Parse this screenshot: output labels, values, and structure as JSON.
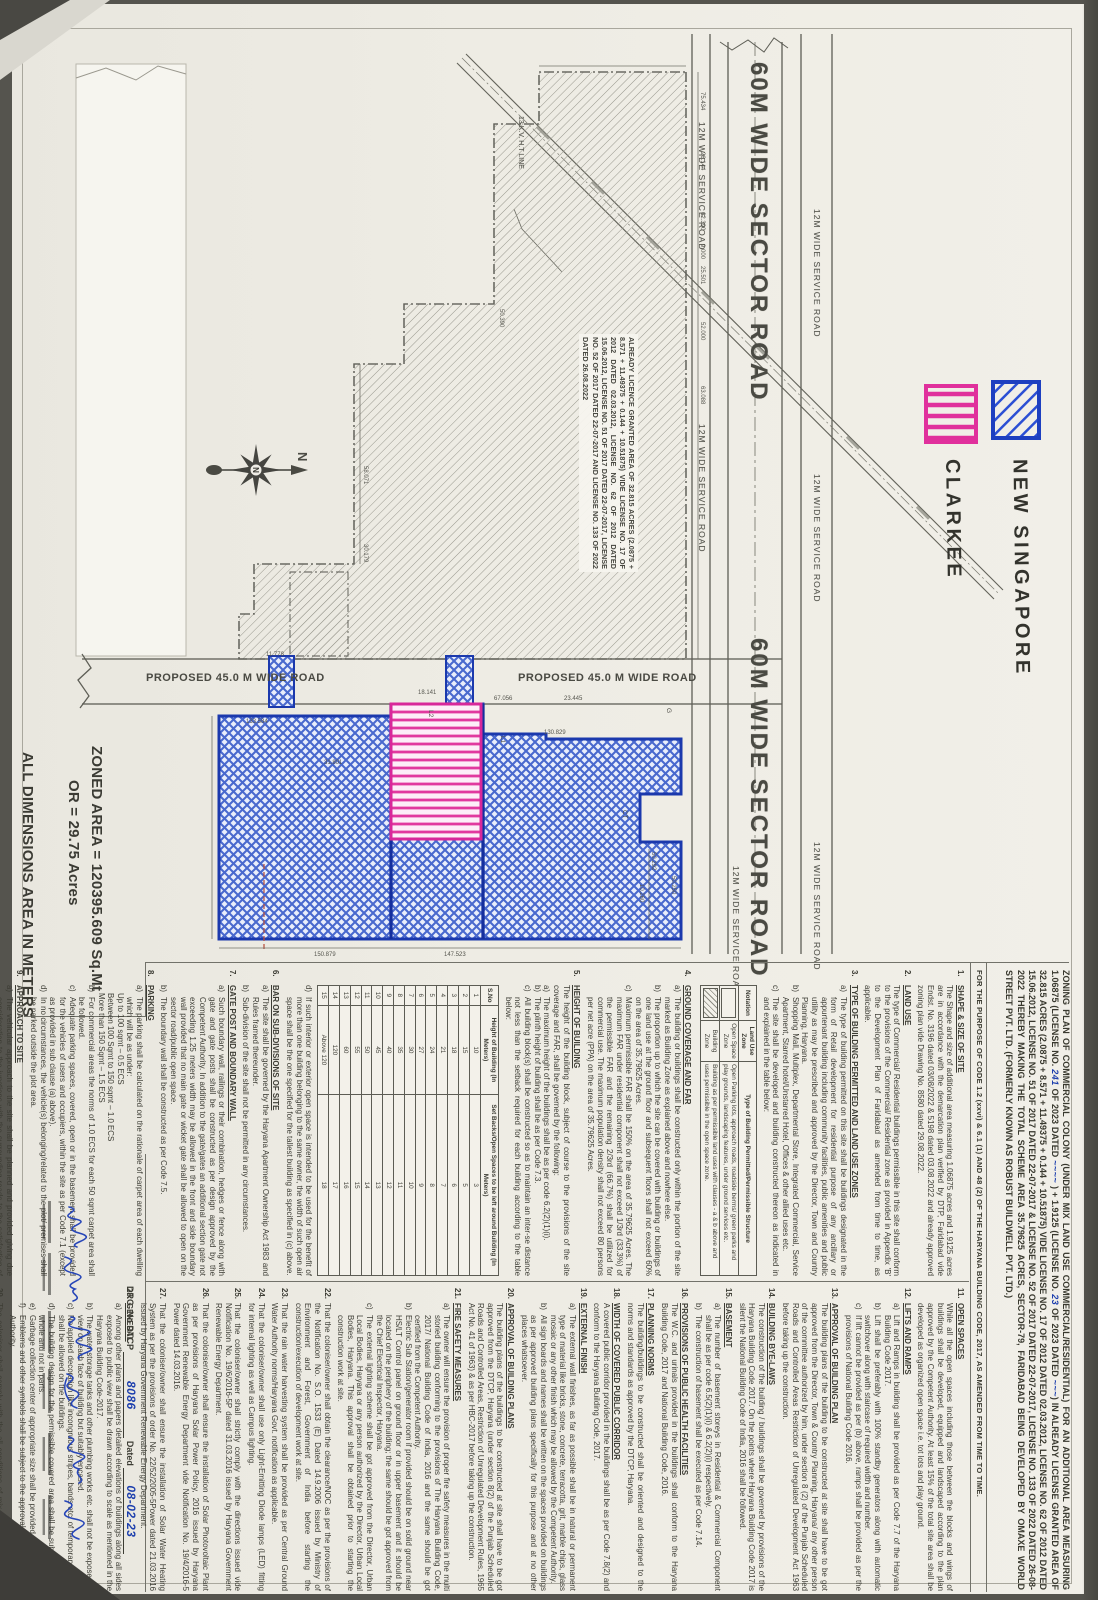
{
  "legend": {
    "items": [
      {
        "label": "NEW SINGAPORE",
        "color": "#2b4fd4",
        "swatch": "blue-diagonal-hatch"
      },
      {
        "label": "CLARKEE",
        "color": "#e0309c",
        "swatch": "pink-stripe-hatch"
      }
    ]
  },
  "compass": {
    "label": "N"
  },
  "roads": {
    "sector": "60M WIDE SECTOR ROAD",
    "service": "12M WIDE SERVICE ROAD",
    "proposed": "PROPOSED 45.0 M WIDE ROAD",
    "ht_line": "13 K.V. H.T LINE"
  },
  "area_note": {
    "line1": "ZONED AREA = 120395.609 Sq.Mt",
    "line2": "OR       = 29.75 Acres",
    "line3": "ALL DIMENSIONS AREA IN METERS"
  },
  "licensed_area_text": "ALREADY LICENCE GRANTED AREA OF 32.815 ACRES (2.0875 + 8.571 + 11.49375 + 0.144 + 10.51875) VIDE LICENSE NO. 17 OF 2012 DATED 02.03.2012, LICENSE NO. 62 OF 2012 DATED 15.06.2012, LICENSE NO. 51 OF 2017 DATED 22-07-2017, LICENSE NO. 52 OF 2017 DATED 22-07-2017 AND LICENSE NO. 133 OF 2022 DATED 26.08.2022",
  "plan": {
    "dims": [
      "75.434",
      "26.144",
      "62.390",
      "25.501",
      "52.000",
      "63.088",
      "50.390",
      "11.778",
      "58.071",
      "30.179",
      "67.056",
      "23.445",
      "130.829",
      "31.801",
      "133.584",
      "150.879",
      "147.523",
      "50.292",
      "10.260",
      "50.250",
      "9.000",
      "18.141"
    ],
    "micro_labels": [
      "L1",
      "L2",
      "G",
      "CT"
    ]
  },
  "header": {
    "parts": [
      {
        "t": "ZONING PLAN OF COMMERCIAL COLONY (UNDER MIX LAND USE COMMERCIAL/RESIDENTIAL) FOR AN ADDITIONAL AREA MEASURING 1.06875 (LICENSE NO. "
      },
      {
        "t": "241",
        "hand": true
      },
      {
        "t": " OF 2023 DATED "
      },
      {
        "t": "~~~~",
        "hand": true
      },
      {
        "t": " ) + 1.9125 (LICENSE NO. "
      },
      {
        "t": "23",
        "hand": true
      },
      {
        "t": " OF 2023 DATED "
      },
      {
        "t": "~~~",
        "hand": true
      },
      {
        "t": ") IN ALREADY LICENSE GRANTED AREA OF 32.815 ACRES (2.0875 + 8.571 + 11.49375 + 0.144 + 10.51875) VIDE LICENSE NO. 17 OF 2012 DATED 02.03.2012, LICENSE NO. 62 OF 2012 DATED 15.06.2012, LICENSE NO. 51 OF 2017 DATED 22-07-2017 & LICENSE NO. 52 OF 2017 DATED 22-07-2017, LICENSE NO. 133 OF 2022 DATED 26-08-2022 THEREBY MAKING THE TOTAL SCHEME AREA 35.79625 ACRES, SECTOR-79, FARIDABAD BEING DEVELOPED BY OMAXE WORLD STREET PVT. LTD. (FORMERLY KNOWN AS ROBUST BUILDWELL PVT. LTD.)"
      }
    ],
    "purpose": "FOR THE PURPOSE OF CODE 1.2 (xxvi) & 6.1 (1) AND 48 (2) OF THE HARYANA BUILDING CODE, 2017, AS AMENDED FROM TIME TO TIME."
  },
  "tables": {
    "landuse": {
      "headers": [
        "Notation",
        "Land Use Zone",
        "Type of Building Permitted/Permissible Structure"
      ],
      "rows": [
        {
          "swatch": "open",
          "zone": "Open Space Zone",
          "desc": "Open Parking lots, approach roads, roadside berms/ green parks and play grounds, landscaping features, under ground services etc."
        },
        {
          "swatch": "hatch",
          "zone": "Building Zone",
          "desc": "Building as per permissible land uses with clauses - a & b above and uses permissible in the open space zone."
        }
      ]
    },
    "setback": {
      "headers": [
        "S.No",
        "Height of Building (In Meters)",
        "Set Backs/Open Spaces to be left around Building (In Meters)"
      ],
      "rows": [
        [
          "1",
          "10",
          "3"
        ],
        [
          "2",
          "15",
          "5"
        ],
        [
          "3",
          "18",
          "6"
        ],
        [
          "4",
          "21",
          "7"
        ],
        [
          "5",
          "24",
          "8"
        ],
        [
          "6",
          "27",
          "9"
        ],
        [
          "7",
          "30",
          "10"
        ],
        [
          "8",
          "35",
          "11"
        ],
        [
          "9",
          "40",
          "12"
        ],
        [
          "10",
          "45",
          "13"
        ],
        [
          "11",
          "50",
          "14"
        ],
        [
          "12",
          "55",
          "15"
        ],
        [
          "13",
          "60",
          "16"
        ],
        [
          "14",
          "120",
          "17"
        ],
        [
          "15",
          "Above 120",
          "18"
        ]
      ]
    }
  },
  "notes": {
    "left": [
      {
        "n": "1",
        "h": "SHAPE & SIZE OF SITE",
        "ps": [
          "The Shape and size of additional area measuring 1.06875 acres and 1.9125 acres are in accordance with the demarcation plan verified by DTP, Faridabad vide Endst. No. 3196 dated 03/08/2022 & 5198 dated 03.08.2022 and already approved zoning plan vide Drawing No. 8580 dated 29.08.2022."
        ]
      },
      {
        "n": "2",
        "h": "LAND USE",
        "ps": [
          "The type of Commercial/ Residential buildings permissible in this site shall conform to the provisions of the Commercial/ Residential zone as provided in Appendix 'B' to the Development Plan of Faridabad as amended from time to time, as applicable."
        ]
      },
      {
        "n": "3",
        "h": "TYPE OF BUILDING PERMITTED AND LAND USE ZONES",
        "items": [
          {
            "k": "a",
            "t": "The type of building permitted on this site shall be buildings designated in the form of Retail development for residential purpose of any ancillary or appurtenant building including community facilities, public amenities and public utility as may be prescribed and approved by the Director, Town and Country Planning, Haryana."
          },
          {
            "k": "b",
            "t": "Shopping Mall, Multiplex, Departmental Store, Integrated Commercial, Service Apartment, Starred hotel/Unstarred Hotel, Offices & other allied uses etc."
          },
          {
            "k": "c",
            "t": "The site shall be developed and building constructed thereon as indicated in and explained in the table below:"
          }
        ],
        "table": "landuse"
      },
      {
        "n": "4",
        "h": "GROUND COVERAGE AND FAR",
        "items": [
          {
            "k": "a",
            "t": "The building or buildings shall be constructed only within the portion of the site marked as Building Zone as explained above and nowhere else."
          },
          {
            "k": "b",
            "t": "The proportion up to which the site can be covered with building or buildings of one land use at the ground floor and subsequent floors shall not exceed 60% on the area of 35.79625 Acres."
          },
          {
            "k": "c",
            "t": "Maximum permissible FAR shall be 150% on the area of 35.79625 Acres. The maximum FAR under residential component shall not exceed 1/3rd (33.3%) of the permissible FAR and the remaining 2/3rd (66.7%) shall be utilized for commercial use. The maximum population density shall not exceed 80 persons per net acre (PPA) on the area of 35.79625 Acres."
          }
        ]
      },
      {
        "n": "5",
        "h": "HEIGHT OF BUILDING",
        "ps": [
          "The height of the building block, subject of course to the provisions of the site coverage and FAR, shall be governed by the following:"
        ],
        "items": [
          {
            "k": "a",
            "t": "The maximum height of the buildings shall be as per code 6.2(2)(1)(i)."
          },
          {
            "k": "b",
            "t": "The plinth height of building shall be as per Code 7.3."
          },
          {
            "k": "c",
            "t": "All building block(s) shall be constructed so as to maintain an inter-se distance not less than the setback required for each building according to the table below:"
          }
        ],
        "table": "setback",
        "after": [
          {
            "k": "d",
            "t": "If such interior or exterior open space is intended to be used for the benefit of more than one building belonging to the same owner, the width of such open air space shall be the one specified for the tallest building as specified in (c) above."
          }
        ]
      },
      {
        "n": "6",
        "h": "BAR ON SUB-DIVISIONS OF SITE",
        "items": [
          {
            "k": "a",
            "t": "The site shall be governed by the Haryana Apartment Ownership Act 1983 and Rules framed thereunder."
          },
          {
            "k": "b",
            "t": "Sub-division of the site shall not be permitted in any circumstances."
          }
        ]
      },
      {
        "n": "7",
        "h": "GATE POST AND BOUNDARY WALL",
        "items": [
          {
            "k": "a",
            "t": "Such boundary wall, railings or their combination, hedges or fence along with gate and gate posts shall be constructed as per design approved by the Competent Authority. In addition to the gate/gates an additional section gate not exceeding 1.25 meters width may be allowed in the front and side boundary wall provided that no main gate or wicket gate shall be allowed to open on the sector road/public open space."
          },
          {
            "k": "b",
            "t": "The boundary wall shall be constructed as per Code 7.5."
          }
        ]
      },
      {
        "n": "8",
        "h": "PARKING",
        "items": [
          {
            "k": "a",
            "t": "The parking shall be calculated on the rationale of carpet area of each dwelling which will be as under:",
            "lines": [
              "Up to 100 sqmt – 0.5 ECS",
              "Between 100 Sqmt to 150 sqmt – 1.0 ECS",
              "More than 150 Sqmt – 1.5 ECS"
            ]
          },
          {
            "k": "b",
            "t": "For commercial areas the norms of 1.0 ECS for each 50 sqmt carpet area shall be followed."
          },
          {
            "k": "c",
            "t": "Adequate parking spaces, covered, open or in the basement shall be provided for the vehicles of users and occupiers, within the site as per Code 7.1 (except as provided in sub clause (a) above)."
          },
          {
            "k": "d",
            "t": "In no circumstances, the vehicle(s) belonging/related to the plot/ premises shall be parked outside the plot area."
          }
        ]
      },
      {
        "n": "9",
        "h": "APPROACH TO SITE",
        "items": [
          {
            "k": "a",
            "t": "The vehicular approach to the site shall be planned and provided giving due consideration to the junctions with the surrounding roads to the satisfaction of the Competent Authority."
          },
          {
            "k": "b",
            "t": "The approach to the site shall be shown on the zoning plan."
          },
          {
            "k": "c",
            "t": "Entry and Exit shall be permitted as indicated/ marked in the plan."
          }
        ]
      },
      {
        "n": "10",
        "h": "PROVISION OF COMMUNITY BUILDINGS",
        "ps": [
          "The community buildings shall be provided as per the composite norms in the Group Housing Colony."
        ]
      }
    ],
    "right": [
      {
        "n": "11",
        "h": "OPEN SPACES",
        "ps": [
          "While all the open spaces including those between the blocks and wings of buildings shall be developed, equipped and landscaped according to the plan approved by the Competent Authority. At least 15% of the total site area shall be developed as organized open space i.e. tot lots and play ground."
        ]
      },
      {
        "n": "12",
        "h": "LIFTS AND RAMPS",
        "items": [
          {
            "k": "a",
            "t": "Lift and Ramps in building shall be provided as per Code 7.7 of the Haryana Building Code 2017."
          },
          {
            "k": "b",
            "t": "Lift shall be preferably with 100% standby generators along with automatic switchover along with staircase of required width and number."
          },
          {
            "k": "c",
            "t": "If lift cannot be provided as per (b) above, ramps shall be provided as per the provisions of National Building Code 2016."
          }
        ]
      },
      {
        "n": "13",
        "h": "APPROVAL OF BUILDING PLAN",
        "ps": [
          "The building plans of the building to be constructed at site shall have to be got approved from the Director, Town & Country Planning, Haryana/ any other person of the committee authorized by him, under section 8 (2) of the Punjab Scheduled Roads and Controlled Areas Restriction of Unregulated Development Act 1963 before taking up the construction."
        ]
      },
      {
        "n": "14",
        "h": "BUILDING BYE-LAWS",
        "ps": [
          "The construction of the building / buildings shall be governed by provisions of the Haryana Building Code 2017. On the points where Haryana Building Code 2017 is silent the National Building Code of India, 2016 shall be followed."
        ]
      },
      {
        "n": "15",
        "h": "BASEMENT",
        "items": [
          {
            "k": "a",
            "t": "The number of basement storeys in Residential & Commercial Component shall be as per code 6.5(2)(1)(i) & 6.2(2)(i) respectively."
          },
          {
            "k": "b",
            "t": "The construction of basement shall be executed as per Code 7.14."
          }
        ]
      },
      {
        "n": "16",
        "h": "PROVISIONS OF PUBLIC HEALTH FACILITIES",
        "ps": [
          "The W.C. and urinals provided in the buildings shall conform to the Haryana Building Code, 2017 and National Building Code, 2016."
        ]
      },
      {
        "n": "17",
        "h": "PLANNING NORMS",
        "ps": [
          "The building/buildings to be constructed shall be oriented and designed to the norms and standards as approved by the DTCP, Haryana."
        ]
      },
      {
        "n": "18",
        "h": "WIDTH OF COVERED PUBLIC CORRIDOR",
        "ps": [
          "A covered public corridor provided in the buildings shall be as per Code 7.8(2) and conform to the Haryana Building Code, 2017."
        ]
      },
      {
        "n": "19",
        "h": "EXTERNAL FINISH",
        "items": [
          {
            "k": "a",
            "t": "The external wall finishes, as far as possible shall be in natural or permanent type of material like bricks, stone, concrete, terracotta, grit, marble chips, glass mosaic or any other finish which may be allowed by the Competent Authority."
          },
          {
            "k": "b",
            "t": "All sign boards and names shall be written on the spaces provided on buildings as per approved building plans specifically for this purpose and at no other places whatsoever."
          }
        ]
      },
      {
        "n": "20",
        "h": "APPROVAL OF BUILDING PLANS",
        "ps": [
          "The building plans of the buildings to be constructed at site shall have to be got approved from the DTCP, Haryana (under section 8(2) of the Punjab Scheduled Roads and Controlled Areas, Restriction of Unregulated Development Rules, 1965 Act No. 41 of 1963) & as per HBC-2017 before taking up the construction."
        ]
      },
      {
        "n": "21",
        "h": "FIRE SAFETY MEASURES",
        "items": [
          {
            "k": "a",
            "t": "The owner will ensure the provision of proper fire safety measures in the multi storied building conforming to the provisions of The Haryana Building Code, 2017/ National Building Code of India, 2016 and the same should be got certified from the Competent Authority."
          },
          {
            "k": "b",
            "t": "Electric Sub Station/generator room if provided should be on solid ground near HS/LT Control panel on ground floor or in upper basement and it should be located on the periphery of the building; the same should be got approved from the Chief Electrical Inspector, Haryana."
          },
          {
            "k": "c",
            "t": "The external lighting scheme shall be got approved from the Director, Urban Local Bodies, Haryana or any person authorized by the Director, Urban Local Bodies, Haryana. This approval shall be obtained prior to starting the construction work at site."
          }
        ]
      },
      {
        "n": "22",
        "ps": [
          "That the coloniser/owner shall obtain the clearance/NOC as per the provisions of the Notification No. S.O. 1533 (E) Dated 14.9.2006 issued by Ministry of Environment and Forest, Government of India before starting the construction/execution of development work at site."
        ]
      },
      {
        "n": "23",
        "ps": [
          "That the rain water harvesting system shall be provided as per Central Ground Water Authority norms/Haryana Govt. notification as applicable."
        ]
      },
      {
        "n": "24",
        "ps": [
          "That the coloniser/owner shall use only Light-Emitting Diode lamps (LED) fitting for internal lighting as well as Campus lighting."
        ]
      },
      {
        "n": "25",
        "ps": [
          "That the coloniser/owner shall strictly comply with the directions issued vide Notification No. 19/6/2016-5P dated 31.03.2016 issued by Haryana Government Renewable Energy Department."
        ]
      },
      {
        "n": "26",
        "ps": [
          "That the coloniser/owner shall ensure the installation of Solar Photovoltaic Plant as per provisions of Haryana Solar Power Policy, 2016 issued by Haryana Government Renewable Energy Department vide Notification No. 19/4/2016-5 Power dated 14.03.2016."
        ]
      },
      {
        "n": "27",
        "ps": [
          "That the coloniser/owner shall ensure the installation of Solar Water Heating System as per the provisions of order No. 22/52/2005-5Power dated 21.03.2016 issued by Haryana Government Renewable Energy Department."
        ]
      },
      {
        "n": "28",
        "h": "GENERAL",
        "items": [
          {
            "k": "a",
            "t": "Among other plans and papers detailed elevations of buildings along all sides exposed to public view shall be drawn according to scale as mentioned in the Haryana Building Code-2017."
          },
          {
            "k": "b",
            "t": "The water storage tanks and other plumbing works etc. shall not be exposed to view on each face of building but suitably encased."
          },
          {
            "k": "c",
            "t": "No applied decoration like incongruous stripes, bands etc. of temporary nature shall be allowed on the buildings."
          },
          {
            "k": "d",
            "t": "The building design for the permissible covered area shall be submitted as a whole and not in parts."
          },
          {
            "k": "e",
            "t": "Garbage collection center of appropriate size shall be provided within the site."
          },
          {
            "k": "f",
            "t": "Emblems and other symbols shall be subject to the approval of the Competent Authority."
          }
        ]
      },
      {
        "n": "29",
        "ps": [
          "The coloniser shall comply with the all conditions of mix land use policy dated 03.03.2016."
        ]
      }
    ]
  },
  "titleblock": {
    "drg_label": "DRG. No DTCP",
    "drg_no": "8086",
    "dated_label": "Dated",
    "date": "08-02-23"
  }
}
